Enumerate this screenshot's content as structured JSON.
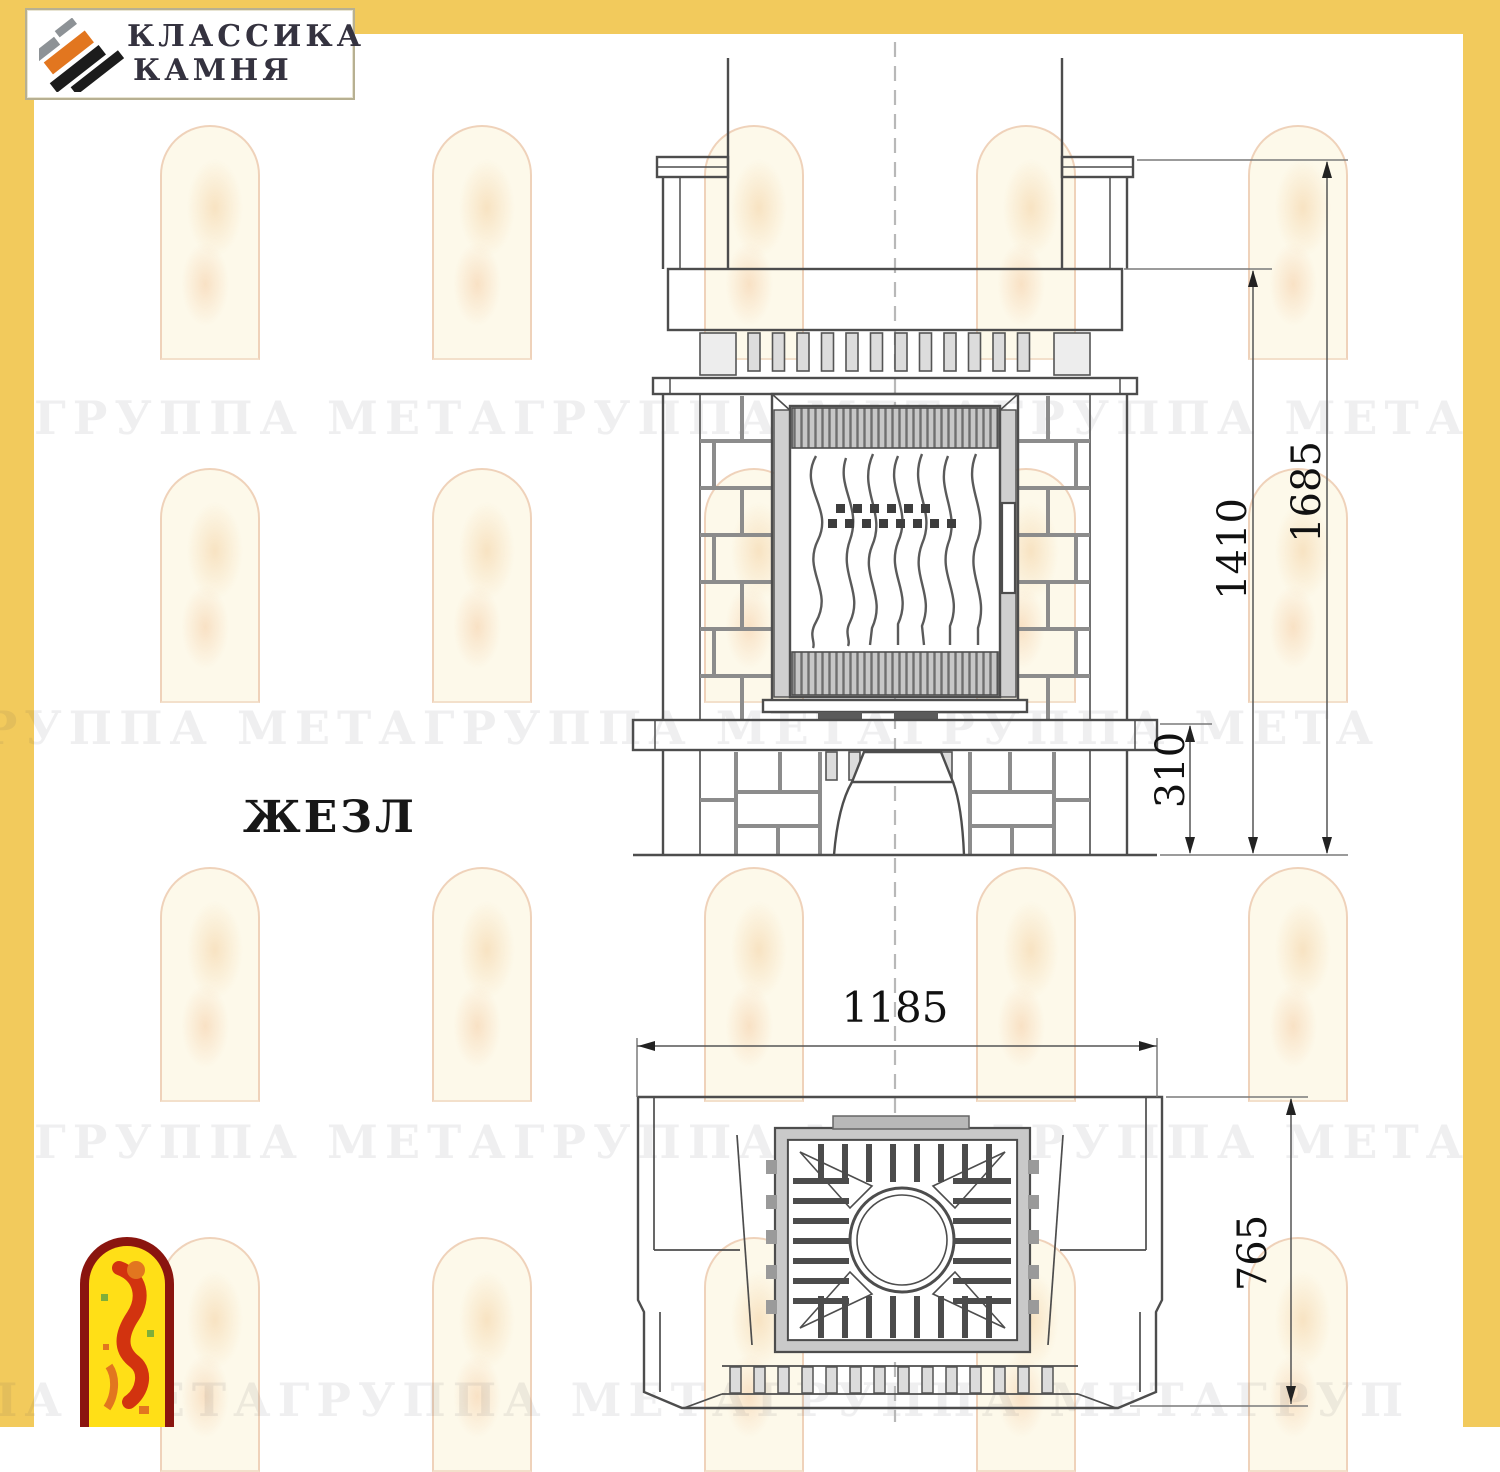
{
  "brand": {
    "name_line1": "КЛАССИКА",
    "name_line2": "КАМНЯ"
  },
  "model_label": "ЖЕЗЛ",
  "watermark": {
    "rows": [
      "ГРУППА МЕТАГРУППА МЕТАГРУППА МЕТАГРУППА МЕТА",
      "ГРУППА МЕТАГРУППА МЕТАГРУППА МЕТАГРУППА МЕТА",
      "ГРУППА МЕТАГРУППА МЕТАГРУППА МЕТАГРУППА МЕТА",
      "ПА МЕТАГРУППА МЕТАГРУППА МЕТАГРУППА МЕТАГРУ"
    ]
  },
  "front_view": {
    "dimensions": {
      "total_height": "1685",
      "mantel_height": "1410",
      "hearth_height": "310"
    }
  },
  "plan_view": {
    "dimensions": {
      "width": "1185",
      "depth": "765"
    }
  },
  "colors": {
    "frame_yellow": "#F2CA5C",
    "drawing_line": "#4D4D4D",
    "mortar_gray": "#8C8C8C",
    "grille_gray": "#C7C7C7",
    "logo_orange": "#E2761F",
    "logo_gray": "#8D9296",
    "logo_black": "#1C1C1C",
    "emblem_red": "#8A150F",
    "emblem_yellow": "#FFDF17",
    "bird_red": "#D2330F"
  }
}
